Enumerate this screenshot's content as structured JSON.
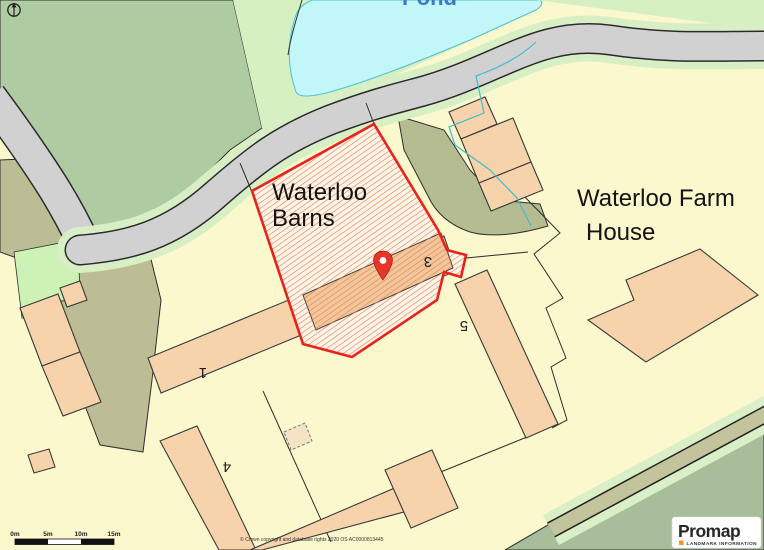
{
  "map": {
    "pond_label": "Pond",
    "plot": {
      "name_line1": "Waterloo",
      "name_line2": "Barns"
    },
    "farm": {
      "name_line1": "Waterloo Farm",
      "name_line2": "House"
    },
    "buildings": [
      {
        "label": "1"
      },
      {
        "label": "3"
      },
      {
        "label": "4"
      },
      {
        "label": "5"
      }
    ],
    "scale_bar": {
      "ticks": [
        "0m",
        "5m",
        "10m",
        "15m"
      ]
    },
    "copyright": "© Crown copyright and database rights 2020 OS AC0000813445",
    "branding": {
      "name": "Promap",
      "tagline": "LANDMARK INFORMATION"
    },
    "colors": {
      "field_yellow": "#FAF8CC",
      "field_green": "#AECBA1",
      "verge_green": "#D8EFC6",
      "pale_green": "#D6F0C2",
      "patch_green": "#CCF2B5",
      "pond_blue": "#C2F6F8",
      "road_grey": "#D1D1D1",
      "track_olive": "#BCBD95",
      "corner_green": "#A8BD9A",
      "building_peach": "#F6D3AB",
      "plot_fill": "#FDF5E9",
      "hatch_orange": "#E8824E",
      "plot_outline_red": "#E9231C",
      "pond_text_blue": "#3C7CC0",
      "brand_orange": "#F7941E"
    }
  }
}
